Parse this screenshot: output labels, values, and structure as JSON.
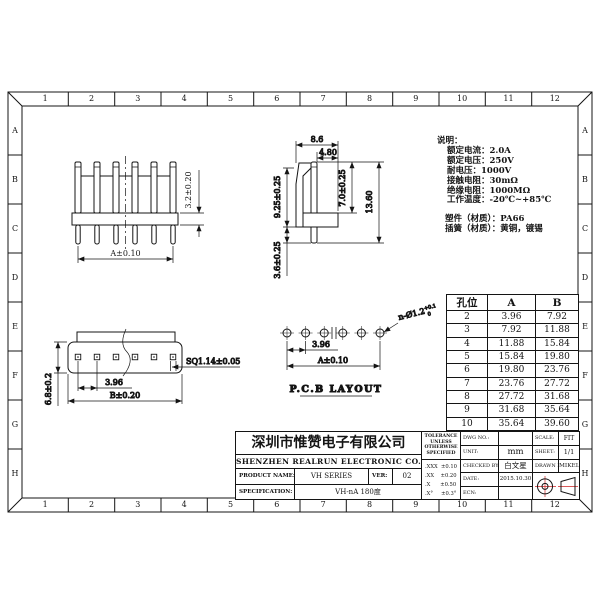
{
  "frame": {
    "cols": [
      "1",
      "2",
      "3",
      "4",
      "5",
      "6",
      "7",
      "8",
      "9",
      "10",
      "11",
      "12"
    ],
    "rows": [
      "A",
      "B",
      "C",
      "D",
      "E",
      "F",
      "G",
      "H"
    ]
  },
  "notes": {
    "title": "说明：",
    "items": [
      "额定电流：2.0A",
      "额定电压：250V",
      "耐电压：1000V",
      "接触电阻：30mΩ",
      "绝缘电阻：1000MΩ",
      "工作温度：-20℃~+85℃"
    ],
    "materials": [
      "塑件（材质）：PA66",
      "插簧（材质）：黄铜，镀锡"
    ]
  },
  "views": {
    "front": {
      "dim_width": "A±0.10",
      "dim_height": "3.2±0.20"
    },
    "side": {
      "dim_top": "8.6",
      "dim_inner": "4.80",
      "dim_left": "9.25±0.25",
      "dim_pin": "7.0±0.25",
      "dim_total": "13.60",
      "dim_tail": "3.6±0.25"
    },
    "bottom": {
      "dim_pitch": "3.96",
      "dim_width": "B±0.20",
      "dim_square": "SQ1.14±0.05",
      "dim_height": "6.8±0.2"
    },
    "pcb": {
      "label": "P.C.B LAYOUT",
      "dim_pitch": "3.96",
      "dim_width": "A±0.10",
      "hole_dim": "n-Ø1.2",
      "hole_tol_top": "+0.1",
      "hole_tol_bot": "0"
    }
  },
  "hole_table": {
    "headers": [
      "孔位",
      "A",
      "B"
    ],
    "rows": [
      [
        "2",
        "3.96",
        "7.92"
      ],
      [
        "3",
        "7.92",
        "11.88"
      ],
      [
        "4",
        "11.88",
        "15.84"
      ],
      [
        "5",
        "15.84",
        "19.80"
      ],
      [
        "6",
        "19.80",
        "23.76"
      ],
      [
        "7",
        "23.76",
        "27.72"
      ],
      [
        "8",
        "27.72",
        "31.68"
      ],
      [
        "9",
        "31.68",
        "35.64"
      ],
      [
        "10",
        "35.64",
        "39.60"
      ]
    ]
  },
  "title_block": {
    "company_cn": "深圳市惟赞电子有限公司",
    "company_en": "SHENZHEN REALRUN ELECTRONIC CO., LTD.",
    "product_name_label": "PRODUCT NAME:",
    "product_name": "VH SERIES",
    "ver_label": "VER:",
    "ver": "02",
    "spec_label": "SPECIFICATION:",
    "spec": "VH-nA 180度",
    "tolerance_title": "TOLERANCE UNLESS OTHERWISE SPECIFIED",
    "tolerances": [
      ".XXX  ±0.10",
      ".XX    ±0.20",
      ".X      ±0.50",
      ".X°     ±0.3°"
    ],
    "dwg_no_label": "DWG NO.:",
    "dwg_no": "",
    "scale_label": "SCALE:",
    "scale": "FIT",
    "unit_label": "UNIT:",
    "unit": "mm",
    "sheet_label": "SHEET:",
    "sheet": "1/1",
    "checked_label": "CHECKED BY:",
    "checked": "白文星",
    "drawn_label": "DRAWN BY:",
    "drawn": "MIKEL",
    "date_label": "DATE:",
    "date": "2015.10.30",
    "ecn_label": "ECN:",
    "ecn": ""
  },
  "colors": {
    "line": "#141414",
    "accent_red": "#cc2222"
  }
}
